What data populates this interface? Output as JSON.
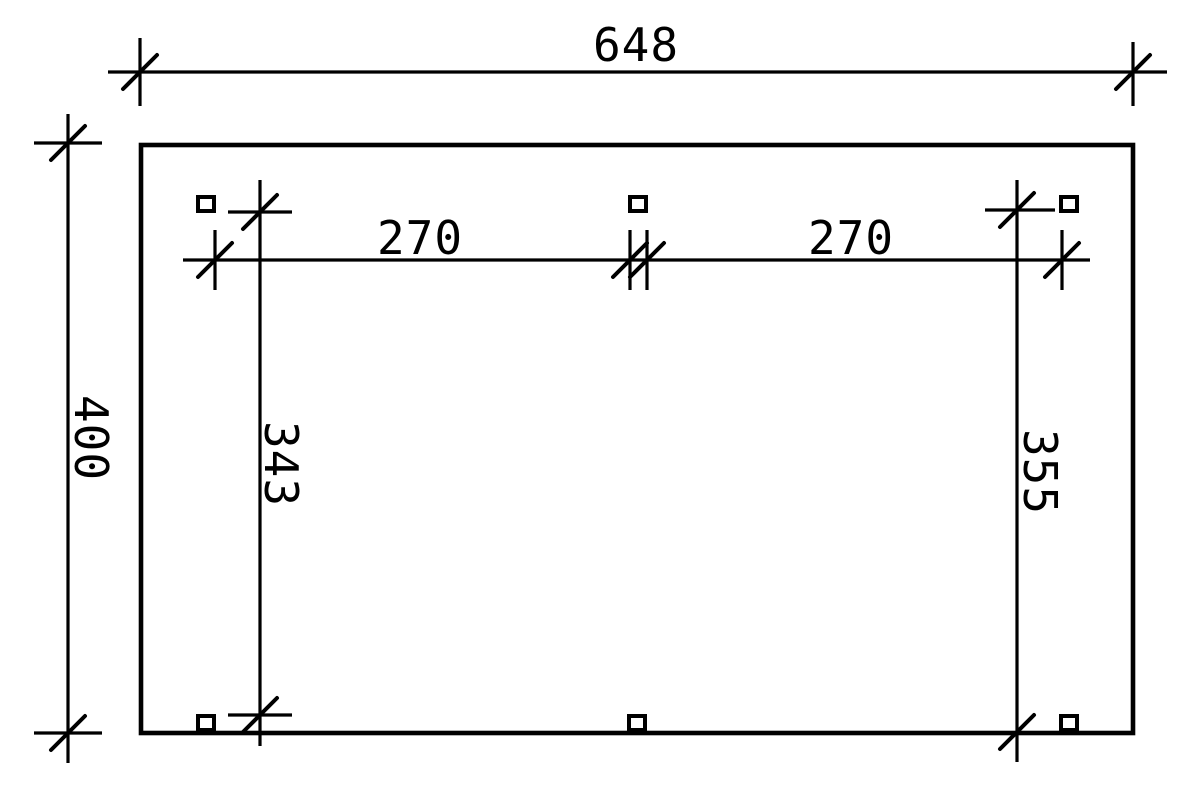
{
  "drawing": {
    "background_color": "#ffffff",
    "line_color": "#000000",
    "labels": {
      "top_total": "648",
      "left_total": "400",
      "inner_span_left": "270",
      "inner_span_right": "270",
      "inner_vertical_left": "343",
      "inner_vertical_right": "355"
    }
  }
}
